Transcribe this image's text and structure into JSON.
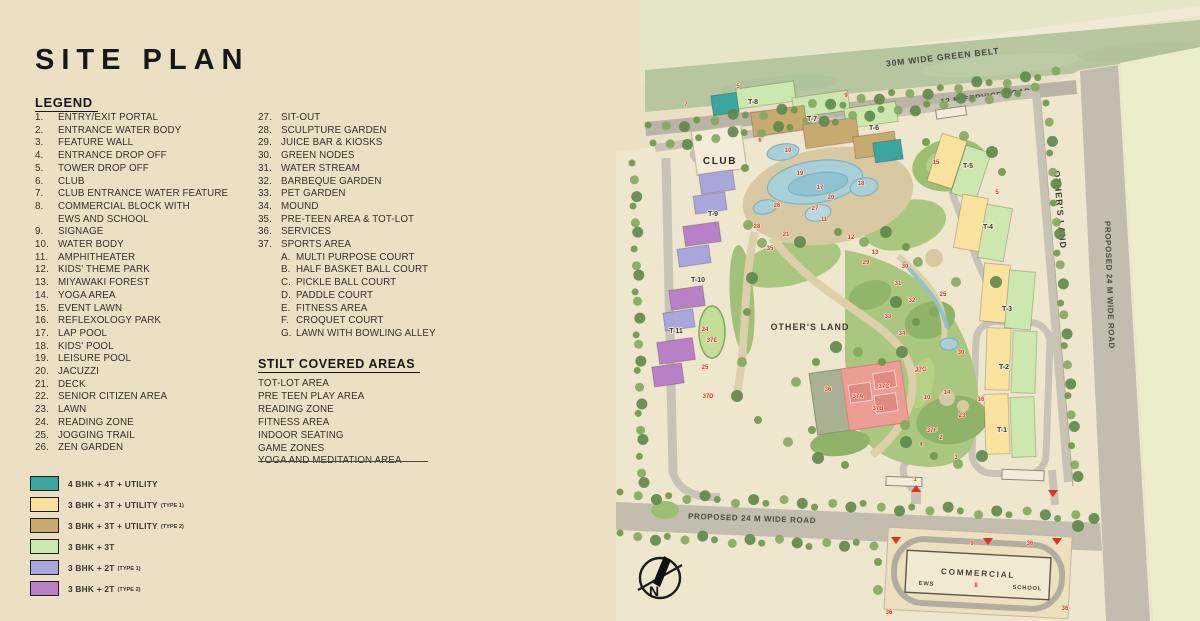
{
  "title": "SITE PLAN",
  "legend": {
    "heading": "LEGEND",
    "column1": [
      {
        "num": "1.",
        "label": "ENTRY/EXIT PORTAL"
      },
      {
        "num": "2.",
        "label": "ENTRANCE WATER BODY"
      },
      {
        "num": "3.",
        "label": "FEATURE WALL"
      },
      {
        "num": "4.",
        "label": "ENTRANCE DROP OFF"
      },
      {
        "num": "5.",
        "label": "TOWER DROP OFF"
      },
      {
        "num": "6.",
        "label": "CLUB"
      },
      {
        "num": "7.",
        "label": "CLUB ENTRANCE WATER FEATURE"
      },
      {
        "num": "8.",
        "label": "COMMERCIAL BLOCK WITH"
      },
      {
        "num": "",
        "label": "EWS AND SCHOOL"
      },
      {
        "num": "9.",
        "label": "SIGNAGE"
      },
      {
        "num": "10.",
        "label": "WATER BODY"
      },
      {
        "num": "11.",
        "label": "AMPHITHEATER"
      },
      {
        "num": "12.",
        "label": "KIDS' THEME PARK"
      },
      {
        "num": "13.",
        "label": "MIYAWAKI FOREST"
      },
      {
        "num": "14.",
        "label": "YOGA AREA"
      },
      {
        "num": "15.",
        "label": "EVENT LAWN"
      },
      {
        "num": "16.",
        "label": "REFLEXOLOGY PARK"
      },
      {
        "num": "17.",
        "label": "LAP POOL"
      },
      {
        "num": "18.",
        "label": "KIDS' POOL"
      },
      {
        "num": "19.",
        "label": "LEISURE POOL"
      },
      {
        "num": "20.",
        "label": "JACUZZI"
      },
      {
        "num": "21.",
        "label": "DECK"
      },
      {
        "num": "22.",
        "label": "SENIOR CITIZEN AREA"
      },
      {
        "num": "23.",
        "label": "LAWN"
      },
      {
        "num": "24.",
        "label": "READING ZONE"
      },
      {
        "num": "25.",
        "label": "JOGGING TRAIL"
      },
      {
        "num": "26.",
        "label": "ZEN GARDEN"
      }
    ],
    "column2": [
      {
        "num": "27.",
        "label": "SIT-OUT"
      },
      {
        "num": "28.",
        "label": "SCULPTURE GARDEN"
      },
      {
        "num": "29.",
        "label": "JUICE BAR & KIOSKS"
      },
      {
        "num": "30.",
        "label": "GREEN NODES"
      },
      {
        "num": "31.",
        "label": "WATER STREAM"
      },
      {
        "num": "32.",
        "label": "BARBEQUE GARDEN"
      },
      {
        "num": "33.",
        "label": "PET GARDEN"
      },
      {
        "num": "34.",
        "label": "MOUND"
      },
      {
        "num": "35.",
        "label": "PRE-TEEN AREA & TOT-LOT"
      },
      {
        "num": "36.",
        "label": "SERVICES"
      },
      {
        "num": "37.",
        "label": "SPORTS AREA"
      }
    ],
    "sports_sub": [
      {
        "num": "A.",
        "label": "MULTI PURPOSE COURT"
      },
      {
        "num": "B.",
        "label": "HALF BASKET BALL COURT"
      },
      {
        "num": "C.",
        "label": "PICKLE BALL COURT"
      },
      {
        "num": "D.",
        "label": "PADDLE COURT"
      },
      {
        "num": "E.",
        "label": "FITNESS AREA"
      },
      {
        "num": "F.",
        "label": "CROQUET COURT"
      },
      {
        "num": "G.",
        "label": "LAWN WITH BOWLING ALLEY"
      }
    ]
  },
  "stilt": {
    "heading": "STILT COVERED AREAS",
    "items": [
      "TOT-LOT AREA",
      "PRE TEEN PLAY AREA",
      "READING ZONE",
      "FITNESS AREA",
      "INDOOR SEATING",
      "GAME ZONES",
      "YOGA AND MEDITATION AREA"
    ]
  },
  "key": [
    {
      "color": "#3aa69f",
      "label": "4 BHK + 4T + UTILITY",
      "type": ""
    },
    {
      "color": "#fbe29e",
      "label": "3 BHK + 3T + UTILITY",
      "type": "(TYPE 1)"
    },
    {
      "color": "#c8aa70",
      "label": "3 BHK + 3T + UTILITY",
      "type": "(TYPE 2)"
    },
    {
      "color": "#cde8ae",
      "label": "3 BHK + 3T",
      "type": ""
    },
    {
      "color": "#a9a6da",
      "label": "3 BHK + 2T",
      "type": "(TYPE 1)"
    },
    {
      "color": "#b980c8",
      "label": "3 BHK + 2T",
      "type": "(TYPE 2)"
    }
  ],
  "map": {
    "labels": {
      "green_belt": "30M WIDE GREEN BELT",
      "service_road": "12 M SERVICE ROAD",
      "right_road": "PROPOSED 24 M WIDE ROAD",
      "bottom_road": "PROPOSED 24 M WIDE ROAD",
      "others_land_right": "OTHER'S LAND",
      "others_land_center": "OTHER'S LAND",
      "club": "CLUB",
      "commercial": "COMMERCIAL",
      "ews": "EWS",
      "school": "SCHOOL",
      "compass_n": "N"
    },
    "towers": [
      {
        "id": "T-8",
        "x": 753,
        "y": 104
      },
      {
        "id": "T-7",
        "x": 812,
        "y": 121
      },
      {
        "id": "T-6",
        "x": 874,
        "y": 130
      },
      {
        "id": "T-9",
        "x": 713,
        "y": 216
      },
      {
        "id": "T-10",
        "x": 698,
        "y": 282
      },
      {
        "id": "T-11",
        "x": 676,
        "y": 333
      },
      {
        "id": "T-5",
        "x": 968,
        "y": 168
      },
      {
        "id": "T-4",
        "x": 988,
        "y": 229
      },
      {
        "id": "T-3",
        "x": 1007,
        "y": 311
      },
      {
        "id": "T-2",
        "x": 1004,
        "y": 369
      },
      {
        "id": "T-1",
        "x": 1002,
        "y": 432
      }
    ],
    "markers": [
      {
        "n": "5",
        "x": 738,
        "y": 88
      },
      {
        "n": "9",
        "x": 846,
        "y": 97
      },
      {
        "n": "7",
        "x": 686,
        "y": 106
      },
      {
        "n": "6",
        "x": 760,
        "y": 142
      },
      {
        "n": "10",
        "x": 788,
        "y": 152
      },
      {
        "n": "15",
        "x": 936,
        "y": 164
      },
      {
        "n": "19",
        "x": 800,
        "y": 175
      },
      {
        "n": "17",
        "x": 820,
        "y": 189
      },
      {
        "n": "18",
        "x": 861,
        "y": 185
      },
      {
        "n": "20",
        "x": 831,
        "y": 199
      },
      {
        "n": "26",
        "x": 777,
        "y": 207
      },
      {
        "n": "27",
        "x": 815,
        "y": 210
      },
      {
        "n": "11",
        "x": 824,
        "y": 221
      },
      {
        "n": "21",
        "x": 786,
        "y": 236
      },
      {
        "n": "28",
        "x": 757,
        "y": 228
      },
      {
        "n": "12",
        "x": 851,
        "y": 239
      },
      {
        "n": "13",
        "x": 875,
        "y": 254
      },
      {
        "n": "35",
        "x": 770,
        "y": 250
      },
      {
        "n": "29",
        "x": 866,
        "y": 264
      },
      {
        "n": "30",
        "x": 905,
        "y": 268
      },
      {
        "n": "31",
        "x": 898,
        "y": 285
      },
      {
        "n": "32",
        "x": 912,
        "y": 302
      },
      {
        "n": "33",
        "x": 888,
        "y": 318
      },
      {
        "n": "34",
        "x": 902,
        "y": 335
      },
      {
        "n": "22",
        "x": 918,
        "y": 372
      },
      {
        "n": "25",
        "x": 943,
        "y": 296
      },
      {
        "n": "30",
        "x": 961,
        "y": 354
      },
      {
        "n": "23",
        "x": 962,
        "y": 417
      },
      {
        "n": "14",
        "x": 947,
        "y": 394
      },
      {
        "n": "16",
        "x": 981,
        "y": 401
      },
      {
        "n": "10",
        "x": 927,
        "y": 399
      },
      {
        "n": "37G",
        "x": 921,
        "y": 371
      },
      {
        "n": "37F",
        "x": 932,
        "y": 432
      },
      {
        "n": "24",
        "x": 705,
        "y": 331
      },
      {
        "n": "37E",
        "x": 712,
        "y": 342
      },
      {
        "n": "25",
        "x": 705,
        "y": 369
      },
      {
        "n": "37D",
        "x": 708,
        "y": 398
      },
      {
        "n": "36",
        "x": 828,
        "y": 391
      },
      {
        "n": "37A",
        "x": 858,
        "y": 398
      },
      {
        "n": "37B",
        "x": 878,
        "y": 410
      },
      {
        "n": "37C",
        "x": 884,
        "y": 388
      },
      {
        "n": "1",
        "x": 915,
        "y": 481
      },
      {
        "n": "4",
        "x": 921,
        "y": 446
      },
      {
        "n": "2",
        "x": 941,
        "y": 439
      },
      {
        "n": "3",
        "x": 956,
        "y": 459
      },
      {
        "n": "5",
        "x": 997,
        "y": 194
      },
      {
        "n": "9",
        "x": 972,
        "y": 545
      },
      {
        "n": "36",
        "x": 1030,
        "y": 545
      },
      {
        "n": "36",
        "x": 889,
        "y": 614
      },
      {
        "n": "36",
        "x": 1065,
        "y": 610
      },
      {
        "n": "8",
        "x": 976,
        "y": 587
      }
    ]
  }
}
